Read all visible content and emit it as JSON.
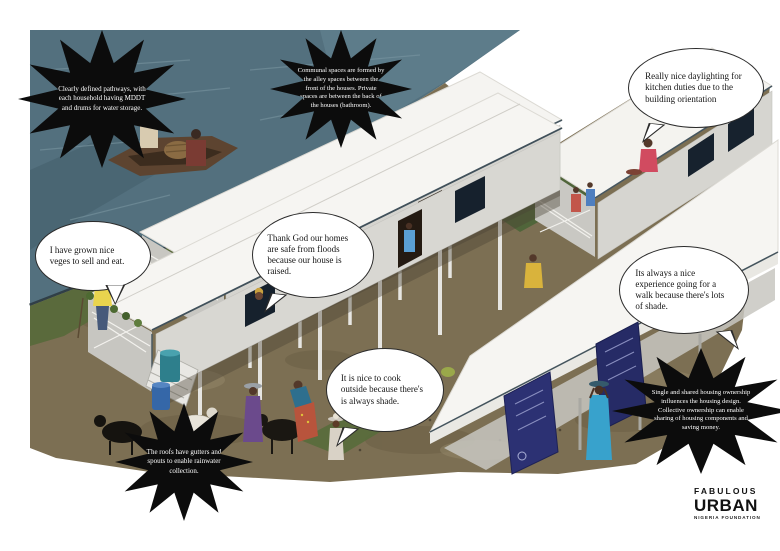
{
  "callouts": {
    "starbursts": [
      {
        "id": "pathways",
        "text": "Clearly defined pathways, with each household having MDDT and drums for water storage."
      },
      {
        "id": "communal",
        "text": "Communal spaces are formed by the alley spaces between the front of the houses. Private spaces are between the back of the houses (bathroom)."
      },
      {
        "id": "roofs",
        "text": "The roofs have gutters and spouts to enable rainwater collection."
      },
      {
        "id": "ownership",
        "text": "Single and shared housing ownership influences the housing design. Collective ownership can enable sharing of housing components and saving money."
      }
    ],
    "speech_bubbles": [
      {
        "id": "daylighting",
        "text": "Really nice daylighting for kitchen duties due to the building orientation"
      },
      {
        "id": "veges",
        "text": "I have grown nice veges to sell and eat."
      },
      {
        "id": "floods",
        "text": "Thank God our homes are safe from floods because our house is raised."
      },
      {
        "id": "walk",
        "text": "Its always a nice experience going for a walk because there's lots of shade."
      },
      {
        "id": "cook",
        "text": "It is nice to cook outside because there's is always shade."
      }
    ]
  },
  "logo": {
    "line1": "FABULOUS",
    "line2": "URBAN",
    "line3": "NIGERIA FOUNDATION"
  },
  "palette": {
    "water": "#53707e",
    "ground": "#7c6f53",
    "grass": "#5a6a3c",
    "roof": "#f5f4f1",
    "wall": "#d8d7d2",
    "window": "#16212d",
    "banner": "#2c3173",
    "starburst_bg": "#0c0c0c",
    "starburst_text": "#ffffff",
    "bubble_bg": "#ffffff",
    "bubble_border": "#2b2b2b"
  }
}
